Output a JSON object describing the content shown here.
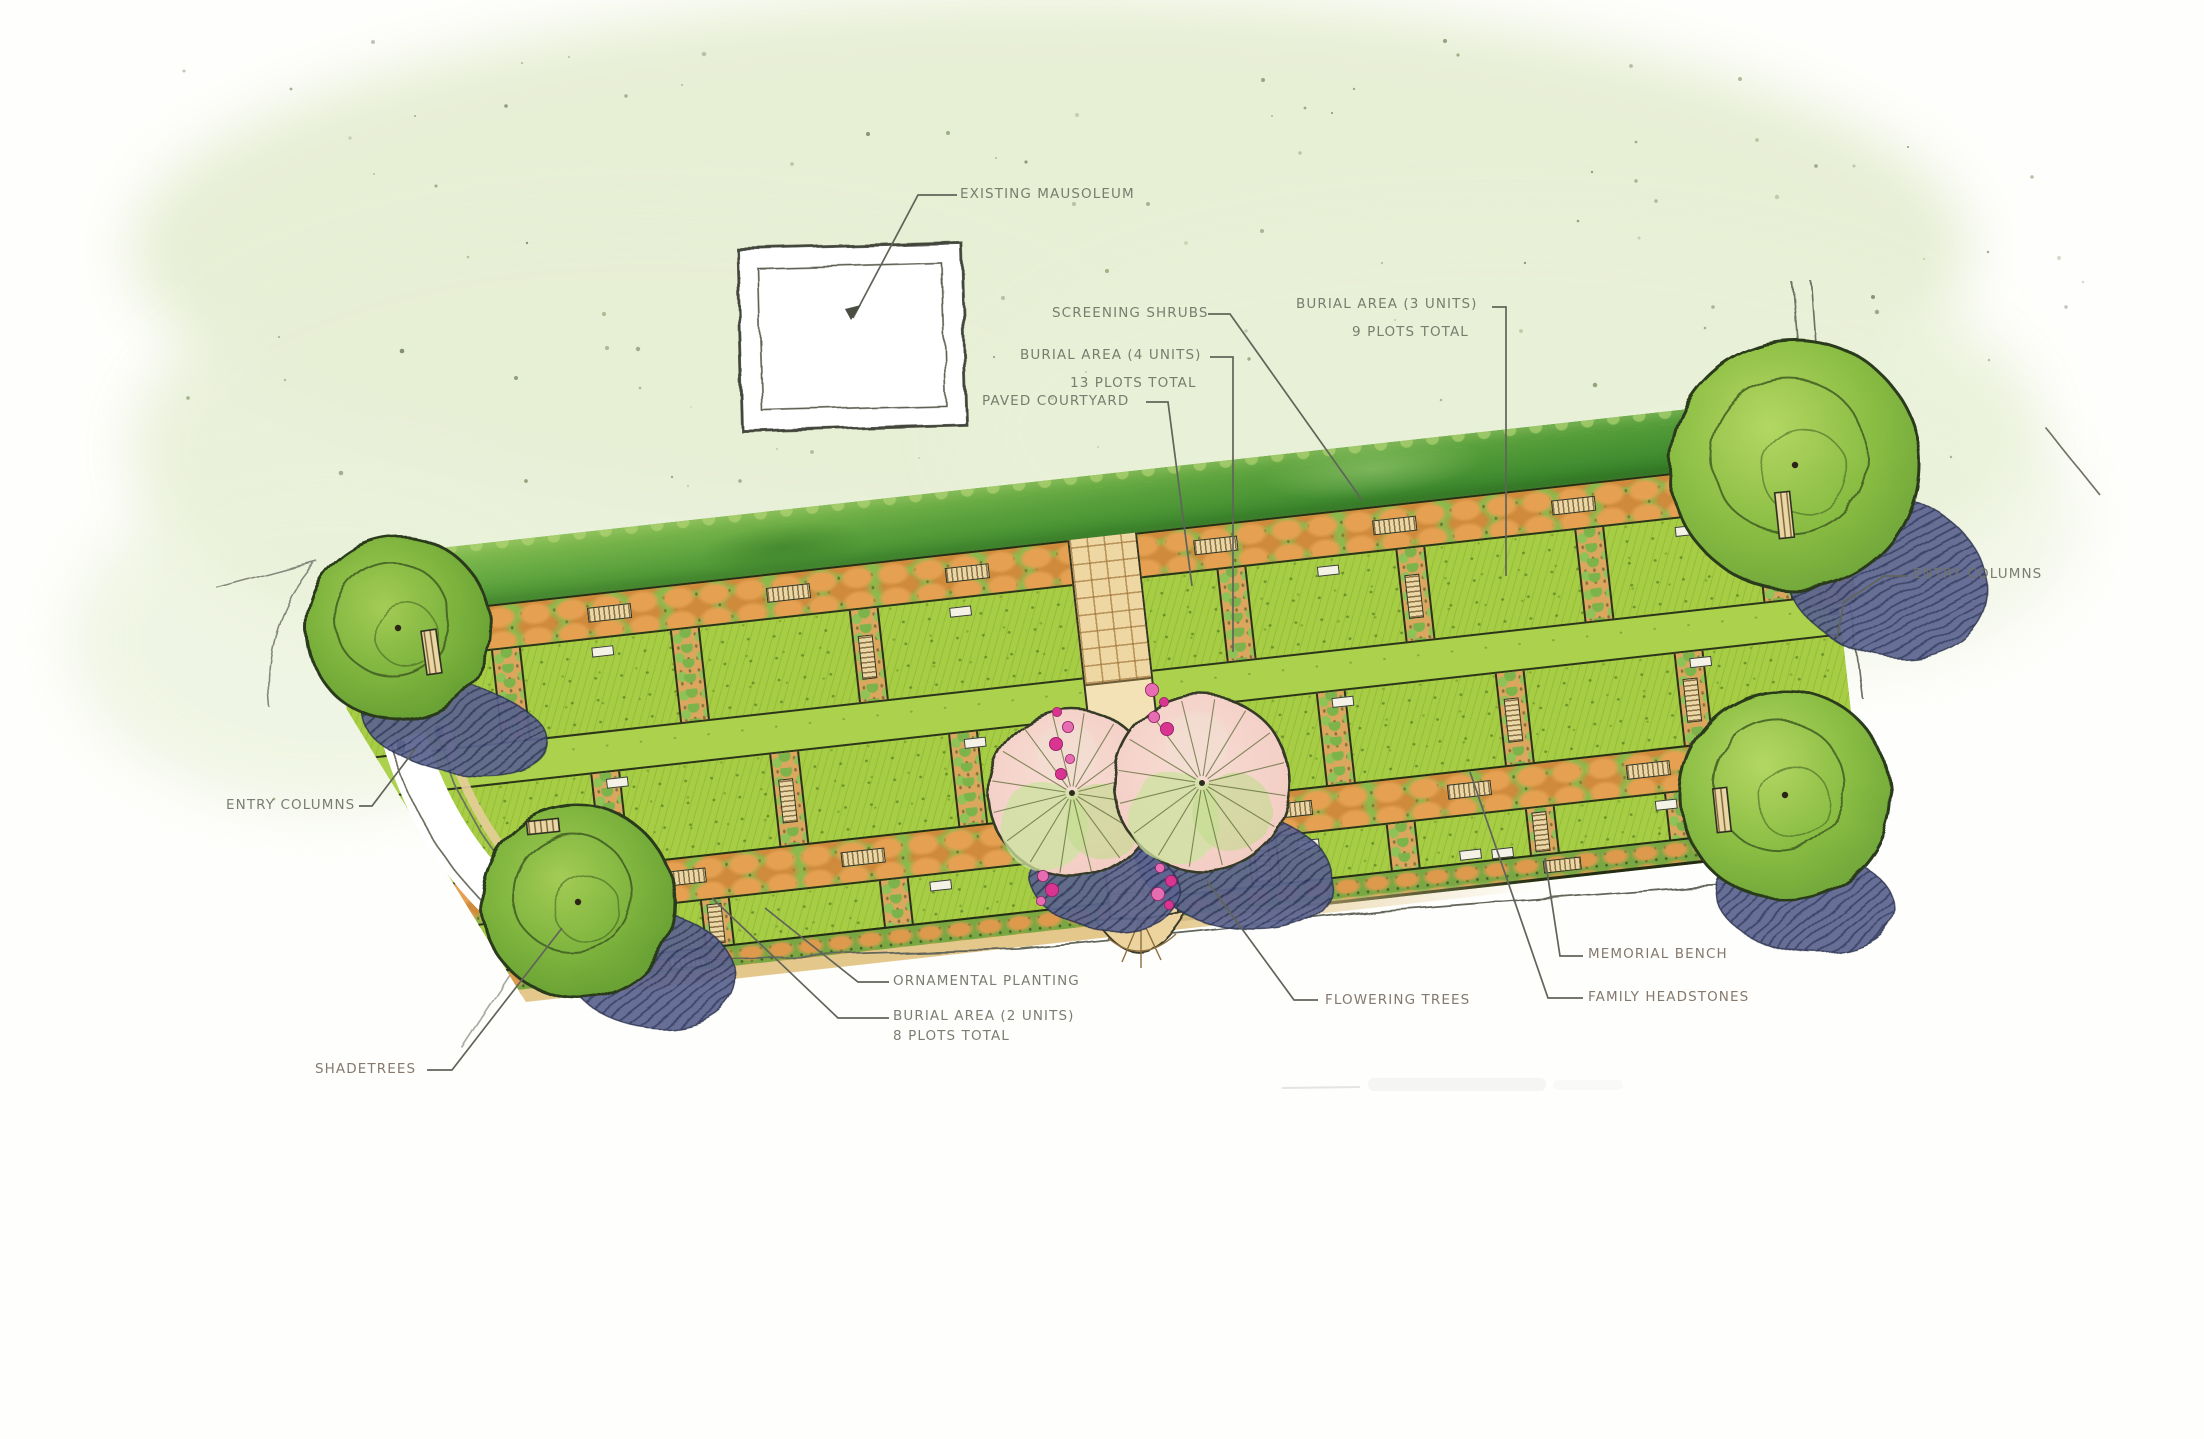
{
  "plan": {
    "labels": {
      "existing_mausoleum": "EXISTING MAUSOLEUM",
      "screening_shrubs": "SCREENING SHRUBS",
      "burial_area_3_line1": "BURIAL AREA (3 UNITS)",
      "burial_area_3_line2": "9 PLOTS TOTAL",
      "burial_area_4_line1": "BURIAL AREA (4 UNITS)",
      "burial_area_4_line2": "13 PLOTS TOTAL",
      "paved_courtyard": "PAVED COURTYARD",
      "entry_columns_right": "ENTRY COLUMNS",
      "entry_columns_left": "ENTRY COLUMNS",
      "ornamental_planting": "ORNAMENTAL PLANTING",
      "burial_area_2_line1": "BURIAL AREA (2 UNITS)",
      "burial_area_2_line2": "8 PLOTS TOTAL",
      "shadetrees": "SHADETREES",
      "flowering_trees": "FLOWERING TREES",
      "memorial_bench": "MEMORIAL BENCH",
      "family_headstones": "FAMILY HEADSTONES"
    },
    "colors": {
      "lawn": "#a6cd43",
      "hedge": "#3f8b2f",
      "planting_strip": "#8aba4c",
      "planting_accent": "#dd9a4d",
      "paving": "#eed7a2",
      "flowering_canopy": "#f5d0c9",
      "shade_canopy": "#85b944",
      "tree_shadow": "#5b6387",
      "flower": "#d9348f",
      "label_text": "#6f7366",
      "wash": "#e7efd5"
    }
  }
}
